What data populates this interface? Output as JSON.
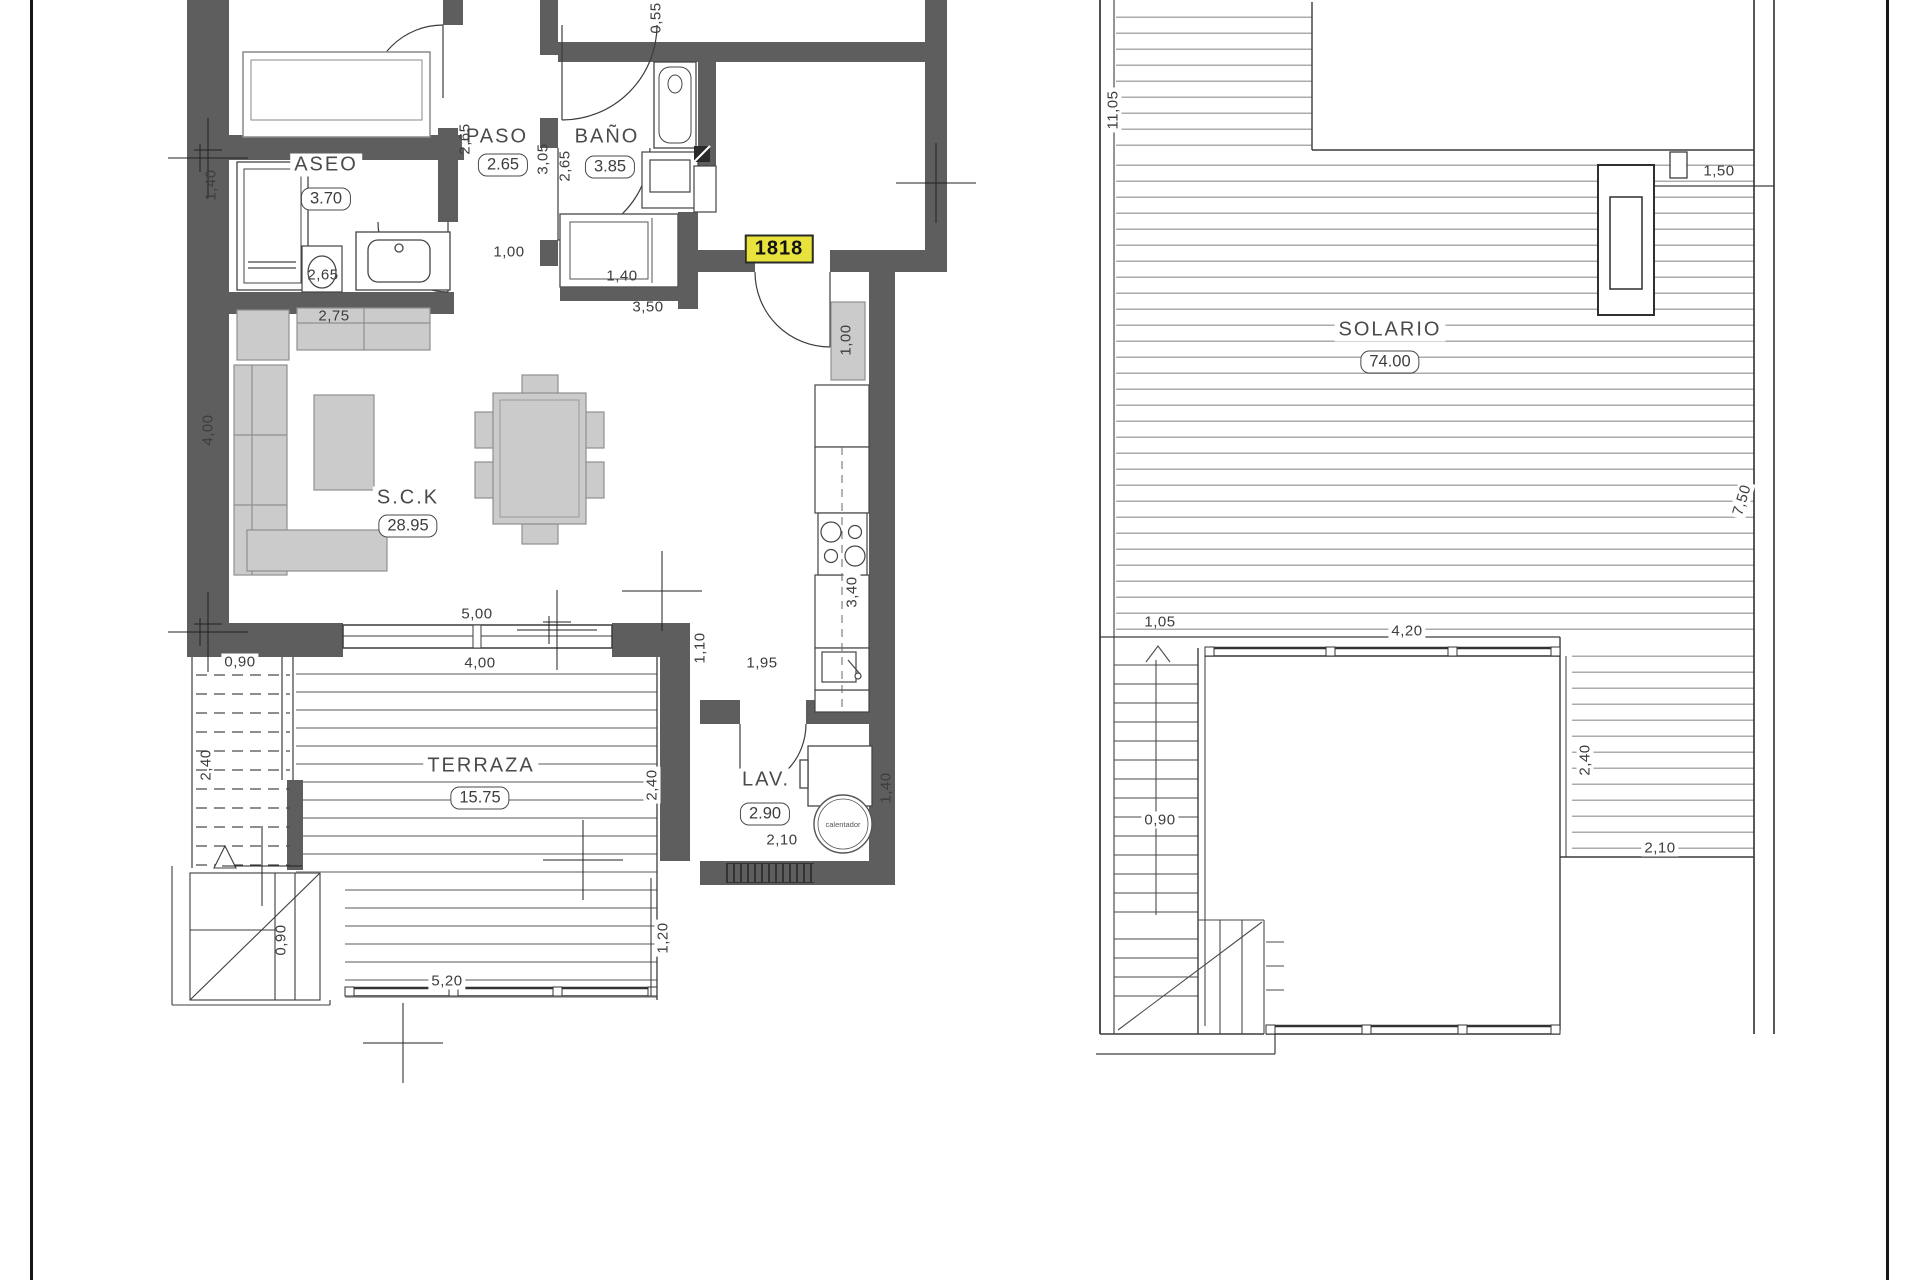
{
  "unit_number": "1818",
  "annotations": {
    "water_heater": "calentador"
  },
  "colors": {
    "wall": "#5e5e5e",
    "furniture": "#cbcbcb",
    "line": "#3c3c3c",
    "deck_line": "#ababab",
    "highlight": "#e8e33c"
  },
  "rooms": [
    {
      "name": "ASEO",
      "value": "3.70",
      "x": 326,
      "y": 165,
      "bx": 326,
      "by": 199
    },
    {
      "name": "PASO",
      "value": "2.65",
      "x": 497,
      "y": 137,
      "bx": 503,
      "by": 165
    },
    {
      "name": "BAÑO",
      "value": "3.85",
      "x": 607,
      "y": 137,
      "bx": 610,
      "by": 167
    },
    {
      "name": "S.C.K",
      "value": "28.95",
      "x": 408,
      "y": 498,
      "bx": 408,
      "by": 526
    },
    {
      "name": "TERRAZA",
      "value": "15.75",
      "x": 481,
      "y": 766,
      "bx": 480,
      "by": 798
    },
    {
      "name": "LAV.",
      "value": "2.90",
      "x": 766,
      "y": 780,
      "bx": 765,
      "by": 814
    },
    {
      "name": "SOLARIO",
      "value": "74.00",
      "x": 1390,
      "y": 330,
      "bx": 1390,
      "by": 362
    }
  ],
  "dimensions": [
    {
      "t": "1,40",
      "x": 211,
      "y": 185,
      "r": -90
    },
    {
      "t": "2,65",
      "x": 323,
      "y": 275,
      "r": 0
    },
    {
      "t": "2,75",
      "x": 334,
      "y": 316,
      "r": 0
    },
    {
      "t": "2,65",
      "x": 465,
      "y": 139,
      "r": -90
    },
    {
      "t": "3,05",
      "x": 543,
      "y": 159,
      "r": -90
    },
    {
      "t": "2,65",
      "x": 565,
      "y": 166,
      "r": -90
    },
    {
      "t": "0,55",
      "x": 656,
      "y": 18,
      "r": -90
    },
    {
      "t": "1,00",
      "x": 509,
      "y": 252,
      "r": 0
    },
    {
      "t": "1,40",
      "x": 622,
      "y": 276,
      "r": 0
    },
    {
      "t": "3,50",
      "x": 648,
      "y": 307,
      "r": 0
    },
    {
      "t": "1,00",
      "x": 846,
      "y": 340,
      "r": -90
    },
    {
      "t": "4,00",
      "x": 208,
      "y": 430,
      "r": -90
    },
    {
      "t": "5,00",
      "x": 477,
      "y": 614,
      "r": 0
    },
    {
      "t": "4,00",
      "x": 480,
      "y": 663,
      "r": 0,
      "bg": true
    },
    {
      "t": "1,10",
      "x": 700,
      "y": 648,
      "r": -90
    },
    {
      "t": "1,95",
      "x": 762,
      "y": 663,
      "r": 0
    },
    {
      "t": "3,40",
      "x": 852,
      "y": 592,
      "r": -90,
      "bg": true
    },
    {
      "t": "0,90",
      "x": 240,
      "y": 662,
      "r": 0,
      "bg": true
    },
    {
      "t": "2,40",
      "x": 206,
      "y": 765,
      "r": -90
    },
    {
      "t": "2,40",
      "x": 652,
      "y": 785,
      "r": -90,
      "bg": true
    },
    {
      "t": "2,10",
      "x": 782,
      "y": 840,
      "r": 0
    },
    {
      "t": "1,40",
      "x": 886,
      "y": 788,
      "r": -90
    },
    {
      "t": "0,90",
      "x": 281,
      "y": 940,
      "r": -90
    },
    {
      "t": "5,20",
      "x": 447,
      "y": 981,
      "r": 0,
      "bg": true
    },
    {
      "t": "1,20",
      "x": 663,
      "y": 938,
      "r": -90,
      "bg": true
    },
    {
      "t": "11,05",
      "x": 1113,
      "y": 110,
      "r": -90,
      "bg": true
    },
    {
      "t": "1,50",
      "x": 1719,
      "y": 171,
      "r": 0
    },
    {
      "t": "7,50",
      "x": 1742,
      "y": 500,
      "r": -73,
      "bg": true
    },
    {
      "t": "1,05",
      "x": 1160,
      "y": 622,
      "r": 0
    },
    {
      "t": "4,20",
      "x": 1407,
      "y": 631,
      "r": 0,
      "bg": true
    },
    {
      "t": "0,90",
      "x": 1160,
      "y": 820,
      "r": 0,
      "bg": true
    },
    {
      "t": "2,40",
      "x": 1585,
      "y": 760,
      "r": -90,
      "bg": true
    },
    {
      "t": "2,10",
      "x": 1660,
      "y": 848,
      "r": 0,
      "bg": true
    }
  ]
}
